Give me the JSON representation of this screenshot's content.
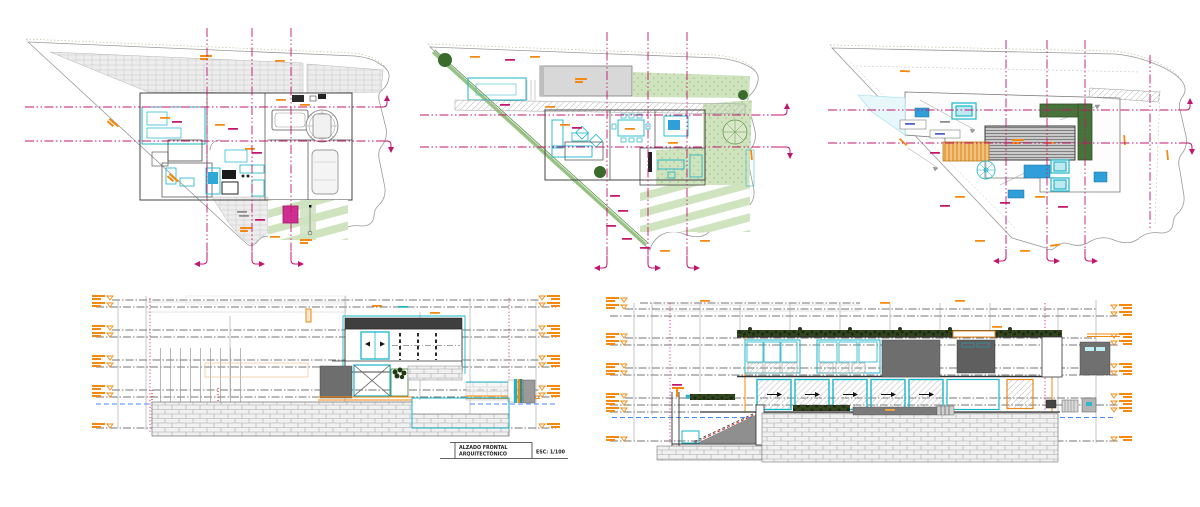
{
  "title_block": {
    "line1": "ALZADO FRONTAL",
    "line2": "ARQUITECTÓNICO",
    "scale": "ESC: 1/100"
  },
  "palette": {
    "grid_magenta": "#c2156b",
    "dotted_pink": "#e255a0",
    "wall_cyan": "#1ab5c9",
    "accent_orange": "#f5890f",
    "lawn_green": "#cfe3bf",
    "stripe_green": "#8fbf7a",
    "dark_green": "#3a6b2c",
    "planter_green": "#47723a",
    "mass_gray": "#6e6e6e",
    "stone_gray": "#a8a8a8",
    "equip_blue": "#2f9fd9",
    "water_blue": "#4b89ff",
    "pool_blue": "#4fc3d8",
    "magenta_fill": "#cf2f91"
  }
}
